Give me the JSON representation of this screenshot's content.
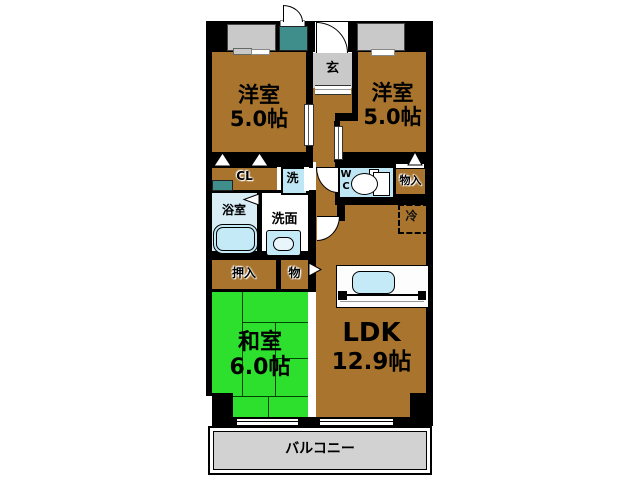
{
  "floorplan": {
    "rooms": {
      "bedroom_left": {
        "name": "洋室",
        "size": "5.0帖"
      },
      "bedroom_right": {
        "name": "洋室",
        "size": "5.0帖"
      },
      "tatami_room": {
        "name": "和室",
        "size": "6.0帖"
      },
      "ldk": {
        "name": "LDK",
        "size": "12.9帖"
      },
      "entrance": {
        "label": "玄"
      },
      "closet": {
        "label": "CL"
      },
      "washer": {
        "label": "洗"
      },
      "bathroom": {
        "label": "浴室"
      },
      "washroom": {
        "label": "洗面"
      },
      "toilet": {
        "line1": "W",
        "line2": "C"
      },
      "storage_right": {
        "label": "物入"
      },
      "refrigerator": {
        "label": "冷"
      },
      "oshiire": {
        "label": "押入"
      },
      "storage_small": {
        "label": "物"
      },
      "balcony": {
        "label": "バルコニー"
      }
    },
    "colors": {
      "room_brown": "#a8742e",
      "tatami_green": "#2ee02e",
      "water_blue": "#bfe6f5",
      "bath_blue": "#d9edf7",
      "entrance_gray": "#c9c9c9",
      "balcony_gray": "#d2d2d2",
      "meter_teal": "#3f8e8c",
      "wall_black": "#000000"
    }
  }
}
